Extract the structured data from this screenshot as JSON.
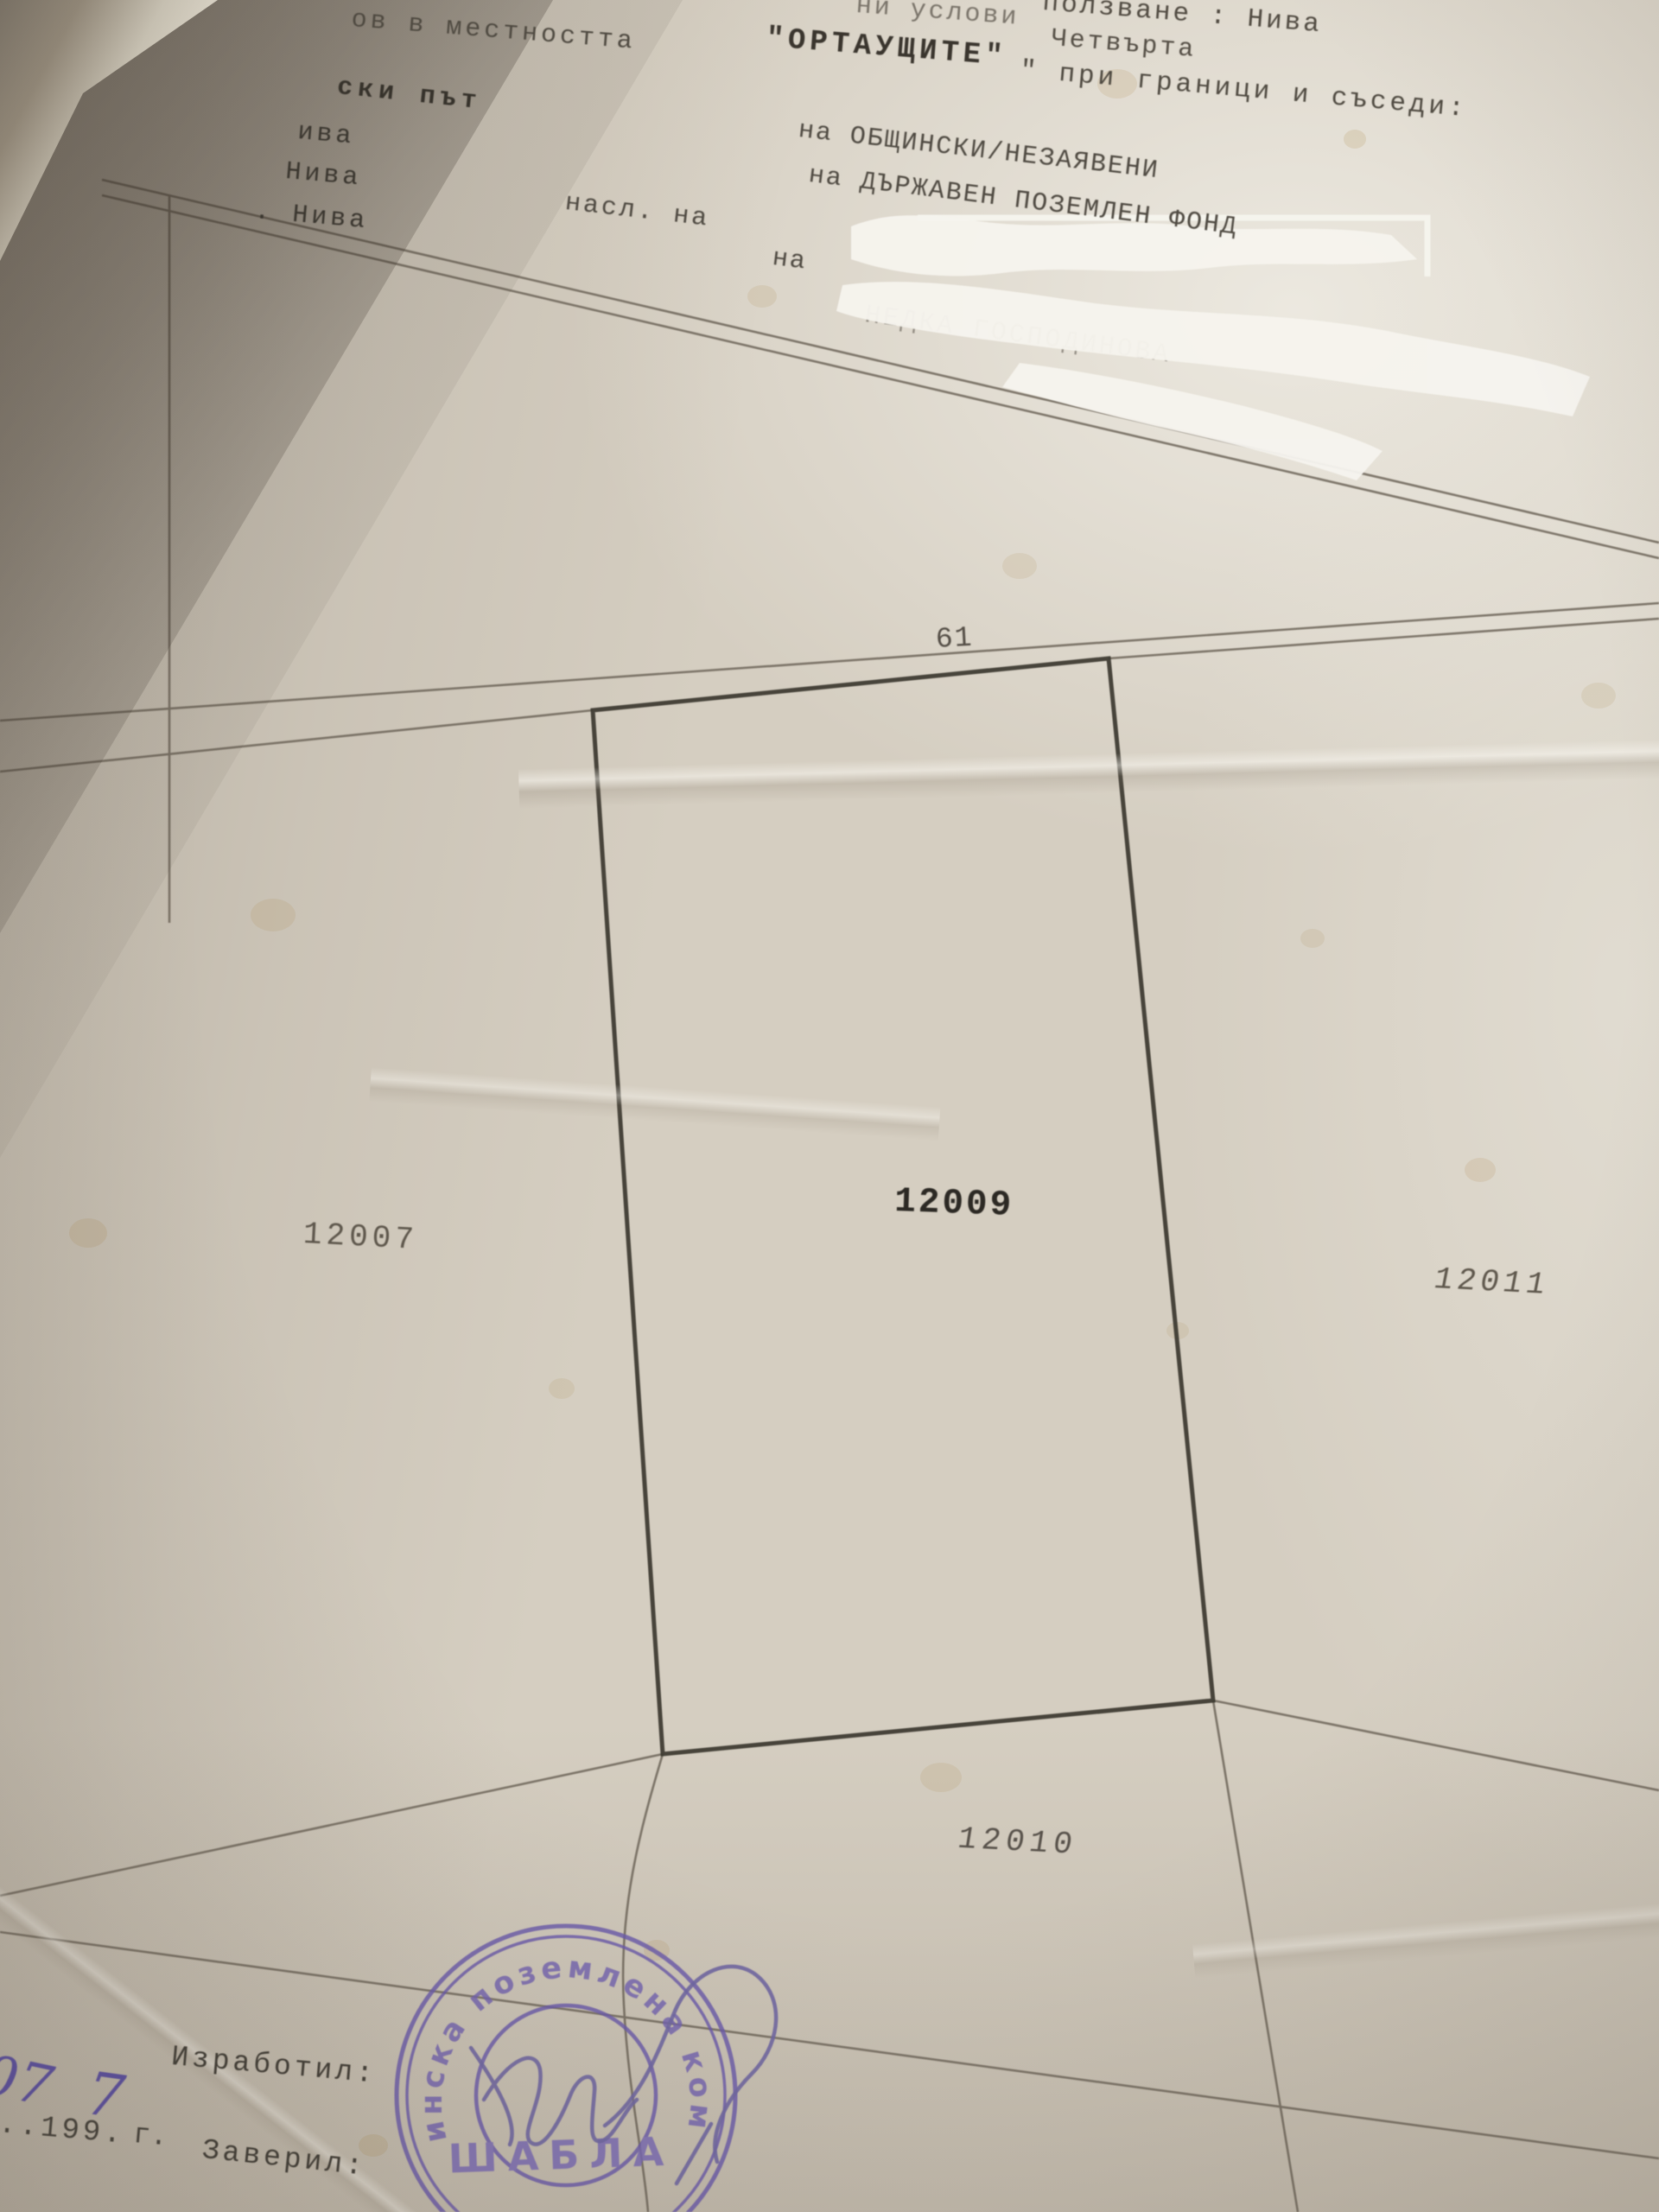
{
  "header": {
    "top_fragment": "ни услови",
    "usage_fragment": "ползване : Нива",
    "location_prefix": "ов в местността",
    "location_name": "\"ОРТАУЩИТЕ\"",
    "category_fragment": "Четвърта",
    "borders_fragment": "\" при граници и съседи:",
    "left_margin_fragments": [
      "ски път",
      "ива",
      "Нива",
      ". Нива"
    ],
    "neighbor_lines": {
      "line1": "на ОБЩИНСКИ/НЕЗАЯВЕНИ",
      "line2": "на ДЪРЖАВЕН ПОЗЕМЛЕН ФОНД",
      "line3_prefix": "насл. на",
      "line4_prefix": "на",
      "redacted_ghost": "НЕДКА ГОСПОДИНОВА"
    }
  },
  "map": {
    "road_label": "61",
    "parcels": [
      {
        "id": "12007"
      },
      {
        "id": "12009"
      },
      {
        "id": "12010"
      },
      {
        "id": "12011"
      }
    ]
  },
  "footer": {
    "made_label": "Изработил:",
    "handwritten_day": "07",
    "date_typed_prefix": "..199.",
    "handwritten_year_digit": "7",
    "year_suffix": "г.",
    "certify_label": "Заверил:",
    "stamp_arc_text": "общинска поземлена комисия",
    "stamp_center_text": "ШАБЛА"
  },
  "colors": {
    "paper": "#d5cec1",
    "ink": "#4b463f",
    "map_line": "#6e665a",
    "parcel_bold_ink": "#2c2924",
    "stamp_purple": "#6b5bab",
    "whiteout": "#f6f4ee"
  }
}
